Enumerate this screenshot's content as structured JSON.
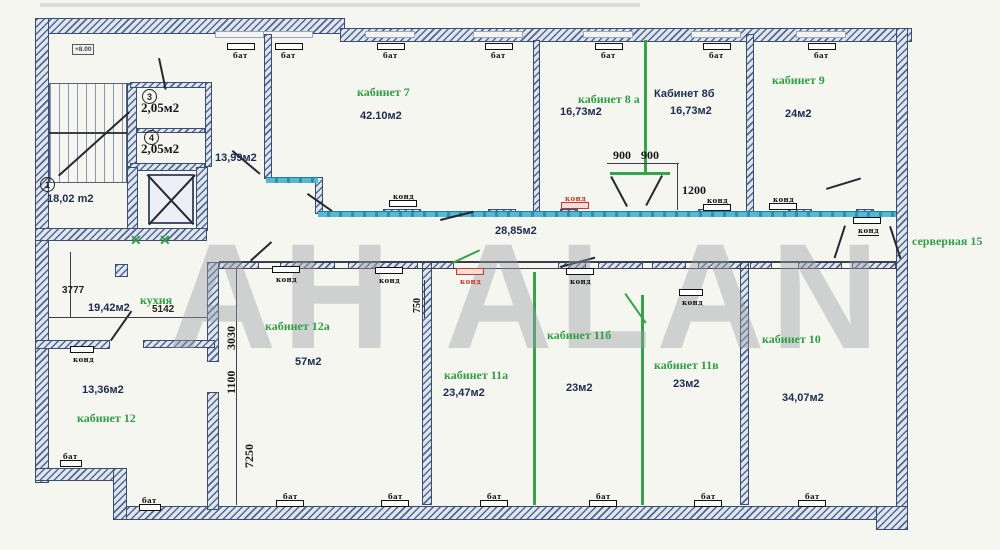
{
  "watermark": "АН ALAN",
  "level_mark": "+8.00",
  "unit_labels": {
    "bat": "бат",
    "kond": "конд"
  },
  "colors": {
    "room_label_green": "#2f9e44",
    "wall_hatch": "#51678c",
    "glass_partition": "#3fa9c9",
    "unit_red": "#c0392b",
    "area_text": "#1c2b4e",
    "watermark_gray": "#9aa0a8"
  },
  "rooms": {
    "stairs": {
      "num": "1",
      "area": "18,02 m2"
    },
    "wc3": {
      "num": "3",
      "area": "2,05м2"
    },
    "wc4": {
      "num": "4",
      "area": "2,05м2"
    },
    "hall": {
      "area": "13,99м2"
    },
    "corridor": {
      "area": "28,85м2"
    },
    "kitchen": {
      "name": "кухня",
      "area": "19,42м2"
    },
    "office7": {
      "name": "кабинет 7",
      "area": "42.10м2"
    },
    "office8a": {
      "name": "кабинет 8 а",
      "area": "16,73м2"
    },
    "office8b": {
      "name": "Кабинет 8б",
      "area": "16,73м2"
    },
    "office9": {
      "name": "кабинет 9",
      "area": "24м2"
    },
    "server": {
      "name": "серверная 15"
    },
    "office12": {
      "name": "кабинет 12",
      "area": "13,36м2"
    },
    "office12a": {
      "name": "кабинет 12а",
      "area": "57м2"
    },
    "office11a": {
      "name": "кабинет 11а",
      "area": "23,47м2"
    },
    "office11b": {
      "name": "кабинет 11б",
      "area": "23м2"
    },
    "office11v": {
      "name": "кабинет 11в",
      "area": "23м2"
    },
    "office10": {
      "name": "кабинет 10",
      "area": "34,07м2"
    }
  },
  "dimensions": {
    "door8_left": "900",
    "door8_right": "900",
    "door8_depth": "1200",
    "kitchen_len": "3777",
    "kitchen_width": "5142",
    "seg_3030": "3030",
    "seg_1100": "1100",
    "seg_7250": "7250",
    "seg_750": "750"
  }
}
